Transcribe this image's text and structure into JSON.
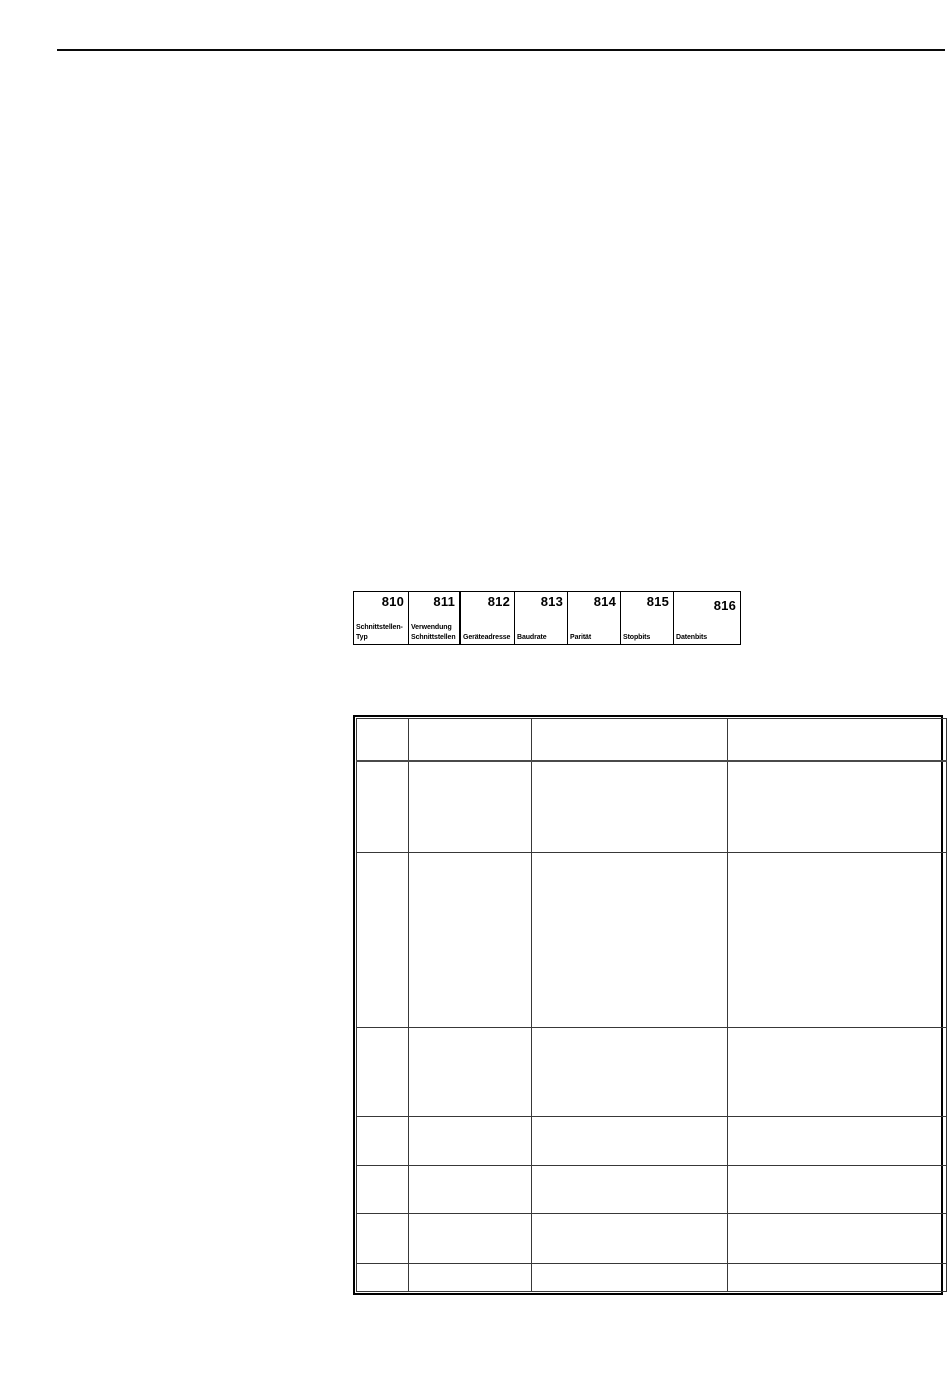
{
  "colors": {
    "page_background": "#ffffff",
    "rule_and_borders": "#000000"
  },
  "param_strip": {
    "cells": [
      {
        "number": "810",
        "label": "Schnittstellen-\nTyp"
      },
      {
        "number": "811",
        "label": "Verwendung\nSchnittstellen"
      },
      {
        "number": "812",
        "label": "Geräteadresse"
      },
      {
        "number": "813",
        "label": "Baudrate"
      },
      {
        "number": "814",
        "label": "Parität"
      },
      {
        "number": "815",
        "label": "Stopbits"
      },
      {
        "number": "816",
        "label": "Datenbits"
      }
    ]
  },
  "main_table": {
    "column_count": 4,
    "row_count": 8,
    "rows": [
      [
        "",
        "",
        "",
        ""
      ],
      [
        "",
        "",
        "",
        ""
      ],
      [
        "",
        "",
        "",
        ""
      ],
      [
        "",
        "",
        "",
        ""
      ],
      [
        "",
        "",
        "",
        ""
      ],
      [
        "",
        "",
        "",
        ""
      ],
      [
        "",
        "",
        "",
        ""
      ],
      [
        "",
        "",
        "",
        ""
      ]
    ]
  }
}
